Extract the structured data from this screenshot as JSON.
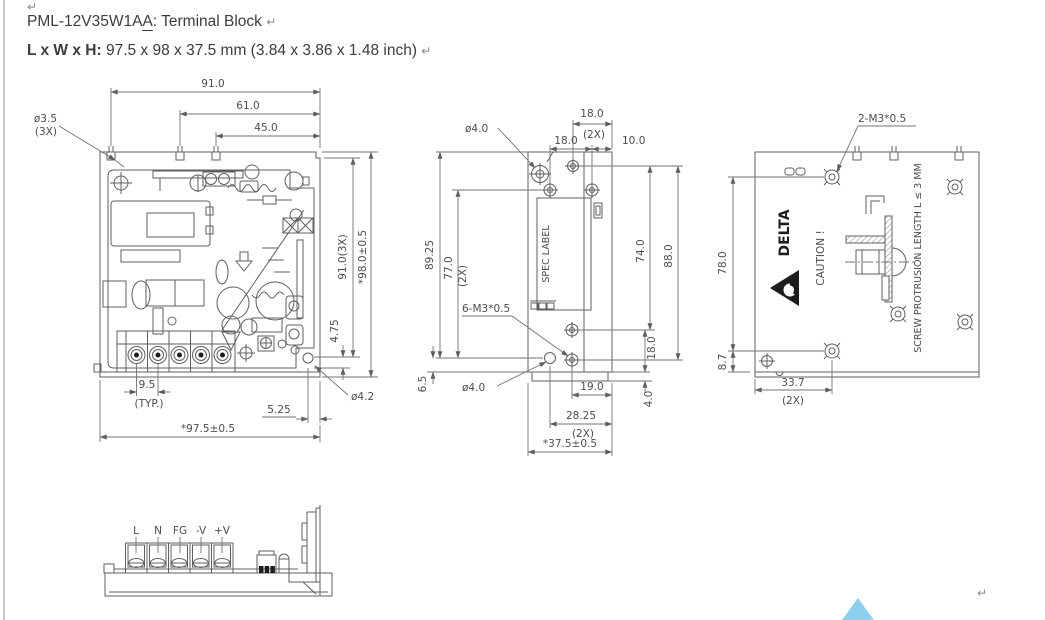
{
  "page": {
    "paragraph_mark": "↵",
    "title": {
      "model_prefix": "PML-12V35W1A",
      "model_suffix_underlined": "A",
      "rest": ": Terminal Block "
    },
    "size_line": {
      "label": "L x W x H:",
      "value": " 97.5 x 98 x 37.5 mm (3.84 x 3.86 x 1.48 inch) "
    },
    "scroll_triangle_color": "#8ccfee"
  },
  "front_view": {
    "dim_91": "91.0",
    "dim_61": "61.0",
    "dim_45": "45.0",
    "hole_top_dia": "ø3.5",
    "hole_top_qty": "(3X)",
    "dim_91_3x": "91.0(3X)",
    "dim_98": "*98.0±0.5",
    "dim_475": "4.75",
    "dim_95": "9.5",
    "dim_typ": "(TYP.)",
    "dim_525": "5.25",
    "dim_975": "*97.5±0.5",
    "hole_bottom_dia": "ø4.2"
  },
  "side_view": {
    "hole_top_dia": "ø4.0",
    "dim_18_top": "18.0",
    "dim_18_top_qty": "(2X)",
    "dim_18": "18.0",
    "dim_10": "10.0",
    "dim_8925": "89.25",
    "dim_77": "77.0",
    "dim_77_qty": "(2X)",
    "spec_label": "SPEC LABEL",
    "dim_74": "74.0",
    "dim_88": "88.0",
    "thread_label": "6-M3*0.5",
    "hole_bottom_dia": "ø4.0",
    "dim_65": "6.5",
    "dim_18_right": "18.0",
    "dim_4": "4.0",
    "dim_19": "19.0",
    "dim_2825": "28.25",
    "dim_2825_qty": "(2X)",
    "dim_375": "*37.5±0.5"
  },
  "back_view": {
    "thread_label": "2-M3*0.5",
    "brand": "DELTA",
    "caution": "CAUTION !",
    "screw_note": "SCREW PROTRUSION LENGTH L ≤ 3 MM",
    "dim_78": "78.0",
    "dim_87": "8.7",
    "dim_337": "33.7",
    "dim_337_qty": "(2X)"
  },
  "terminal_view": {
    "pins": [
      "L",
      "N",
      "FG",
      "-V",
      "+V"
    ]
  }
}
